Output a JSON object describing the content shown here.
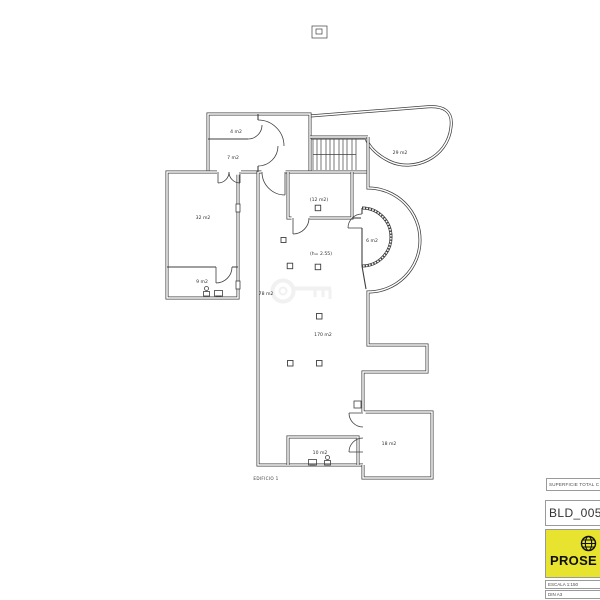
{
  "plan": {
    "building_label": "EDIFICIO 1",
    "line_color": "#3f3f3f",
    "rooms": [
      {
        "id": "room-4",
        "label": "4 m2"
      },
      {
        "id": "room-7",
        "label": "7 m2"
      },
      {
        "id": "terrace-29",
        "label": "29 m2"
      },
      {
        "id": "room-32",
        "label": "32 m2"
      },
      {
        "id": "room-9",
        "label": "9 m2"
      },
      {
        "id": "room-12",
        "label": "(12 m2)"
      },
      {
        "id": "bay-6",
        "label": "6 m2"
      },
      {
        "id": "height-note",
        "label": "(h= 2.55)"
      },
      {
        "id": "hall-78",
        "label": "78 m2"
      },
      {
        "id": "hall-170",
        "label": "170 m2"
      },
      {
        "id": "room-10",
        "label": "10 m2"
      },
      {
        "id": "room-18",
        "label": "18 m2"
      }
    ]
  },
  "titleblock": {
    "superficie_label": "SUPERFICIE TOTAL C",
    "drawing_id": "BLD_0052",
    "logo_text": "PROSE",
    "logo_bg_color": "#e7e32f",
    "scale_label": "ESCALA 1:150",
    "sheet_label": "DIN A3"
  }
}
